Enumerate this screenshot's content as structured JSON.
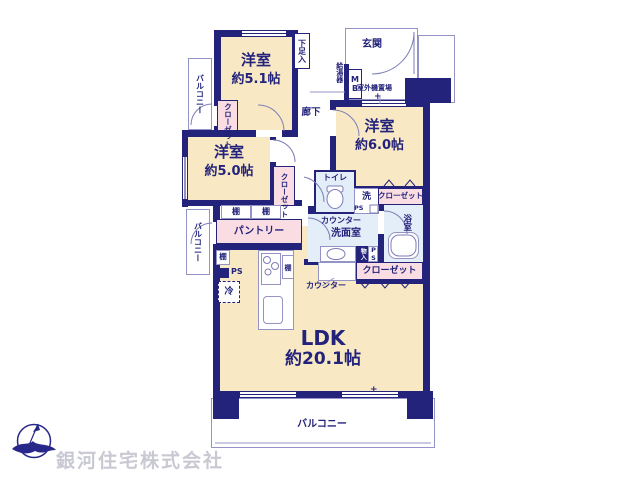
{
  "company": "銀河住宅株式会社",
  "rooms": {
    "bedroom1": {
      "name": "洋室",
      "size": "約5.1帖"
    },
    "bedroom2": {
      "name": "洋室",
      "size": "約5.0帖"
    },
    "bedroom3": {
      "name": "洋室",
      "size": "約6.0帖"
    },
    "ldk": {
      "name": "LDK",
      "size": "約20.1帖"
    }
  },
  "labels": {
    "balcony": "バルコニー",
    "closet": "クローゼット",
    "pantry": "パントリー",
    "shelf": "棚",
    "entrance": "玄関",
    "shoe_cupboard": "下足入",
    "water_heater": "給湯器",
    "meter_box": "MB",
    "outdoor_unit": "室外機置場",
    "hallway": "廊下",
    "toilet": "トイレ",
    "washer": "洗",
    "pipe_space": "PS",
    "counter": "カウンター",
    "washroom": "洗面室",
    "bathroom": "浴室",
    "storage": "物入",
    "refrigerator": "冷",
    "plus_mark": "+"
  },
  "colors": {
    "wall": "#23237b",
    "floor": "#f8e9c4",
    "closet": "#fadde2",
    "wet": "#e4eef9",
    "line": "#9393c6",
    "logo": "#28288a",
    "watermark": "#c9c9d4"
  }
}
